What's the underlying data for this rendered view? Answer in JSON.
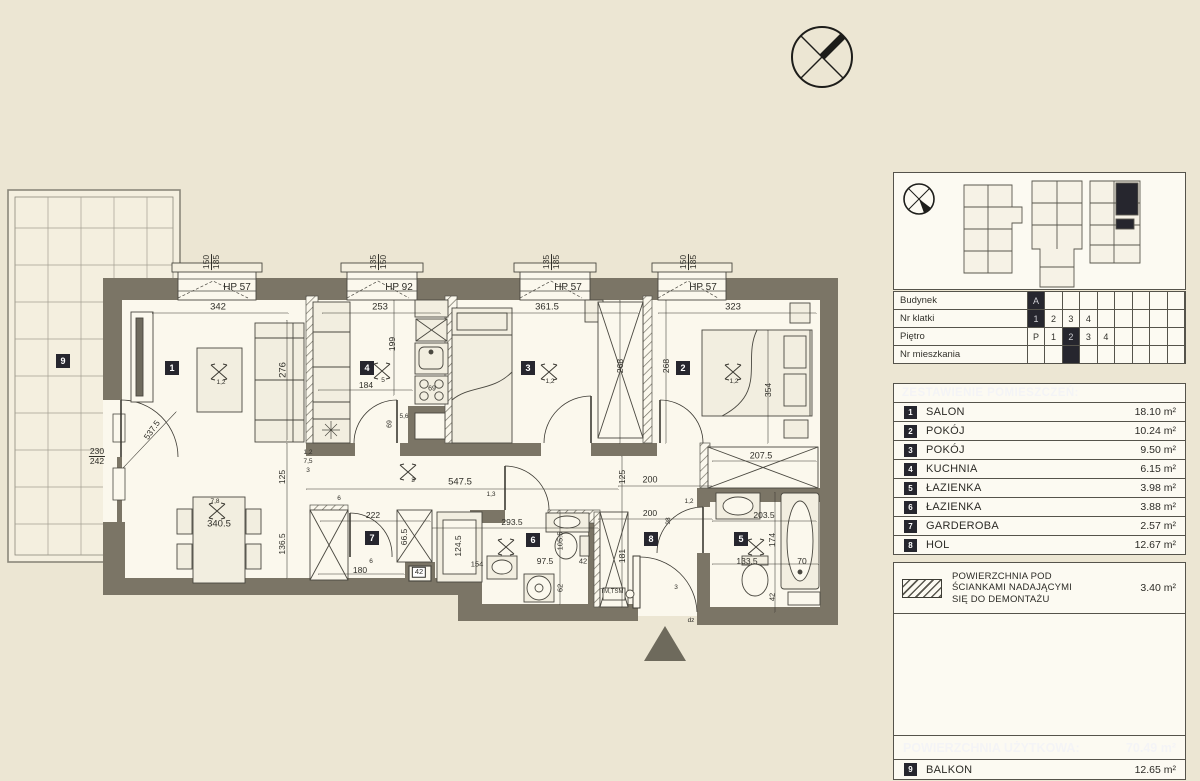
{
  "colors": {
    "paper": "#ece6d3",
    "floor": "#fbf8ed",
    "wall": "#7b7566",
    "accent_dark": "#26262e",
    "line": "#3c3a33"
  },
  "compass": {
    "icon": "north-compass"
  },
  "floorplan": {
    "entrance_marker": "entrance-triangle",
    "badges": [
      {
        "n": "1",
        "x": 172,
        "y": 368
      },
      {
        "n": "2",
        "x": 683,
        "y": 368
      },
      {
        "n": "3",
        "x": 528,
        "y": 368
      },
      {
        "n": "4",
        "x": 367,
        "y": 368
      },
      {
        "n": "5",
        "x": 741,
        "y": 539
      },
      {
        "n": "6",
        "x": 533,
        "y": 540
      },
      {
        "n": "7",
        "x": 372,
        "y": 538
      },
      {
        "n": "8",
        "x": 651,
        "y": 539
      },
      {
        "n": "9",
        "x": 63,
        "y": 361
      }
    ],
    "labels": [
      {
        "t": "HP 57",
        "x": 237,
        "y": 288,
        "s": 10
      },
      {
        "t": "HP 92",
        "x": 399,
        "y": 288,
        "s": 10
      },
      {
        "t": "HP 57",
        "x": 568,
        "y": 288,
        "s": 10
      },
      {
        "t": "HP 57",
        "x": 703,
        "y": 288,
        "s": 10
      },
      {
        "t": "150 185",
        "x": 211,
        "y": 262,
        "r": -90,
        "c": "fv"
      },
      {
        "t": "135 150",
        "x": 378,
        "y": 262,
        "r": -90,
        "c": "fv"
      },
      {
        "t": "135 185",
        "x": 551,
        "y": 262,
        "r": -90,
        "c": "fv"
      },
      {
        "t": "150 185",
        "x": 688,
        "y": 262,
        "r": -90,
        "c": "fv"
      },
      {
        "t": "342",
        "x": 218,
        "y": 307,
        "s": 9.5
      },
      {
        "t": "253",
        "x": 380,
        "y": 307,
        "s": 9.5
      },
      {
        "t": "361.5",
        "x": 547,
        "y": 307,
        "s": 9.5
      },
      {
        "t": "323",
        "x": 733,
        "y": 307,
        "s": 9.5
      },
      {
        "t": "184",
        "x": 366,
        "y": 385
      },
      {
        "t": "69",
        "x": 432,
        "y": 389,
        "s": 7
      },
      {
        "t": "69",
        "x": 390,
        "y": 424,
        "r": -90,
        "s": 7
      },
      {
        "t": "199",
        "x": 392,
        "y": 344,
        "r": -90
      },
      {
        "t": "276",
        "x": 283,
        "y": 370,
        "r": -90,
        "s": 9.5
      },
      {
        "t": "268",
        "x": 620,
        "y": 366,
        "r": -90
      },
      {
        "t": "268",
        "x": 666,
        "y": 366,
        "r": -90
      },
      {
        "t": "354",
        "x": 768,
        "y": 390,
        "r": -90
      },
      {
        "t": "230 242",
        "x": 97,
        "y": 456,
        "c": "fh"
      },
      {
        "t": "537.5",
        "x": 152,
        "y": 430,
        "r": -55
      },
      {
        "t": "125",
        "x": 282,
        "y": 477,
        "r": -90
      },
      {
        "t": "136.5",
        "x": 282,
        "y": 544,
        "r": -90
      },
      {
        "t": "547.5",
        "x": 460,
        "y": 482,
        "s": 9.5
      },
      {
        "t": "200",
        "x": 650,
        "y": 480,
        "s": 9
      },
      {
        "t": "207.5",
        "x": 761,
        "y": 456,
        "s": 9
      },
      {
        "t": "222",
        "x": 373,
        "y": 515
      },
      {
        "t": "293.5",
        "x": 512,
        "y": 522
      },
      {
        "t": "200",
        "x": 650,
        "y": 513
      },
      {
        "t": "98",
        "x": 669,
        "y": 521,
        "r": -90,
        "s": 6.5
      },
      {
        "t": "203.5",
        "x": 764,
        "y": 515
      },
      {
        "t": "340.5",
        "x": 219,
        "y": 524,
        "s": 9.5
      },
      {
        "t": "125",
        "x": 622,
        "y": 477,
        "r": -90
      },
      {
        "t": "181",
        "x": 622,
        "y": 556,
        "r": -90
      },
      {
        "t": "66.5",
        "x": 404,
        "y": 537,
        "r": -90
      },
      {
        "t": "124.5",
        "x": 458,
        "y": 546,
        "r": -90
      },
      {
        "t": "105.5",
        "x": 560,
        "y": 541,
        "r": -90,
        "s": 7.5
      },
      {
        "t": "62",
        "x": 560,
        "y": 588,
        "r": -90,
        "s": 7.5
      },
      {
        "t": "174",
        "x": 772,
        "y": 540,
        "r": -90
      },
      {
        "t": "42",
        "x": 772,
        "y": 597,
        "r": -90,
        "s": 7.5
      },
      {
        "t": "154",
        "x": 477,
        "y": 564,
        "s": 7.5
      },
      {
        "t": "97.5",
        "x": 545,
        "y": 561
      },
      {
        "t": "42",
        "x": 583,
        "y": 561,
        "s": 7.5
      },
      {
        "t": "180",
        "x": 360,
        "y": 570
      },
      {
        "t": "42",
        "x": 419,
        "y": 572,
        "s": 7.5,
        "c": "box"
      },
      {
        "t": "133.5",
        "x": 747,
        "y": 561
      },
      {
        "t": "70",
        "x": 802,
        "y": 561
      },
      {
        "t": "7,8",
        "x": 215,
        "y": 502,
        "s": 6.5
      },
      {
        "t": "5",
        "x": 383,
        "y": 381,
        "s": 6.5
      },
      {
        "t": "1,2",
        "x": 221,
        "y": 383,
        "s": 6.5
      },
      {
        "t": "1,2",
        "x": 550,
        "y": 382,
        "s": 6.5
      },
      {
        "t": "1,2",
        "x": 734,
        "y": 382,
        "s": 6.5
      },
      {
        "t": "3",
        "x": 413,
        "y": 481,
        "s": 6.5
      },
      {
        "t": "1,2",
        "x": 308,
        "y": 453,
        "s": 6.5
      },
      {
        "t": "7,5",
        "x": 308,
        "y": 462,
        "s": 6.5
      },
      {
        "t": "3",
        "x": 308,
        "y": 471,
        "s": 6.5
      },
      {
        "t": "5,6",
        "x": 404,
        "y": 417,
        "s": 6.5
      },
      {
        "t": "6",
        "x": 339,
        "y": 499,
        "s": 6.5
      },
      {
        "t": "6",
        "x": 371,
        "y": 562,
        "s": 6.5
      },
      {
        "t": "1,3",
        "x": 491,
        "y": 495,
        "s": 6.5
      },
      {
        "t": "1,2",
        "x": 689,
        "y": 502,
        "s": 6.5
      },
      {
        "t": "TM,TSM",
        "x": 612,
        "y": 592,
        "s": 6
      },
      {
        "t": "dz",
        "x": 691,
        "y": 621,
        "s": 6.5
      },
      {
        "t": "3",
        "x": 676,
        "y": 588,
        "s": 6.5
      }
    ]
  },
  "panel": {
    "meta": {
      "rows": [
        {
          "label": "Budynek",
          "cells": [
            "A*",
            "",
            "",
            "",
            "",
            "",
            "",
            "",
            ""
          ]
        },
        {
          "label": "Nr klatki",
          "cells": [
            "1*",
            "2",
            "3",
            "4",
            "",
            "",
            "",
            "",
            ""
          ]
        },
        {
          "label": "Piętro",
          "cells": [
            "P",
            "1",
            "2*",
            "3",
            "4",
            "",
            "",
            "",
            ""
          ]
        },
        {
          "label": "Nr mieszkania",
          "cells": [
            "",
            "",
            "*",
            "",
            "",
            "",
            "",
            "",
            ""
          ]
        }
      ]
    },
    "rooms_header": "ZESTAWIENIE POMIESZCZEŃ:",
    "rooms": [
      {
        "no": "1",
        "name": "SALON",
        "area": "18.10 m²"
      },
      {
        "no": "2",
        "name": "POKÓJ",
        "area": "10.24 m²"
      },
      {
        "no": "3",
        "name": "POKÓJ",
        "area": "9.50 m²"
      },
      {
        "no": "4",
        "name": "KUCHNIA",
        "area": "6.15 m²"
      },
      {
        "no": "5",
        "name": "ŁAZIENKA",
        "area": "3.98 m²"
      },
      {
        "no": "6",
        "name": "ŁAZIENKA",
        "area": "3.88 m²"
      },
      {
        "no": "7",
        "name": "GARDEROBA",
        "area": "2.57 m²"
      },
      {
        "no": "8",
        "name": "HOL",
        "area": "12.67 m²"
      }
    ],
    "demolition": {
      "l1": "POWIERZCHNIA POD",
      "l2": "ŚCIANKAMI NADAJĄCYMI",
      "l3": "SIĘ DO DEMONTAŻU",
      "area": "3.40 m²"
    },
    "total": {
      "label": "POWIERZCHNIA UŻYTKOWA:",
      "value": "70.49 m²"
    },
    "balkon": {
      "no": "9",
      "name": "BALKON",
      "area": "12.65 m²"
    }
  }
}
